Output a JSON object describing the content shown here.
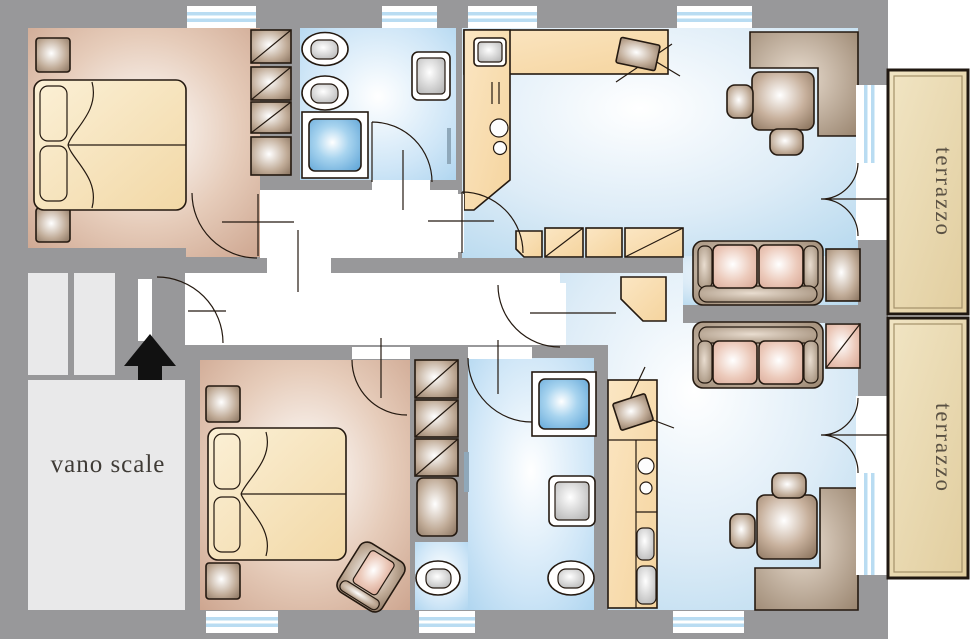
{
  "page": {
    "title": "Apartment floor plan"
  },
  "labels": {
    "stairwell": "vano scale",
    "terrace_top": "terrazzo",
    "terrace_bottom": "terrazzo"
  },
  "stair_arrow_direction": "up",
  "colors": {
    "wall": "#98989a",
    "outside": "#ffffff",
    "corridor": "#ffffff",
    "stair_room": "#e9e9ea",
    "bedroom_floor": "#dcbfae",
    "bathroom_floor": "#c6e1f5",
    "living_floor": "#d8e9f6",
    "kitchen_counter": "#f8ddb0",
    "terrace": "#e8d7ae",
    "terrace_border": "#1f1710",
    "wood_furniture": "#b59f8a",
    "sofa_cushion": "#eccabb",
    "bed_linen": "#f7e7c6",
    "window_glass": "#b9dcf2",
    "outline": "#241910",
    "arrow": "#111111",
    "label_text": "#3f3b36"
  }
}
